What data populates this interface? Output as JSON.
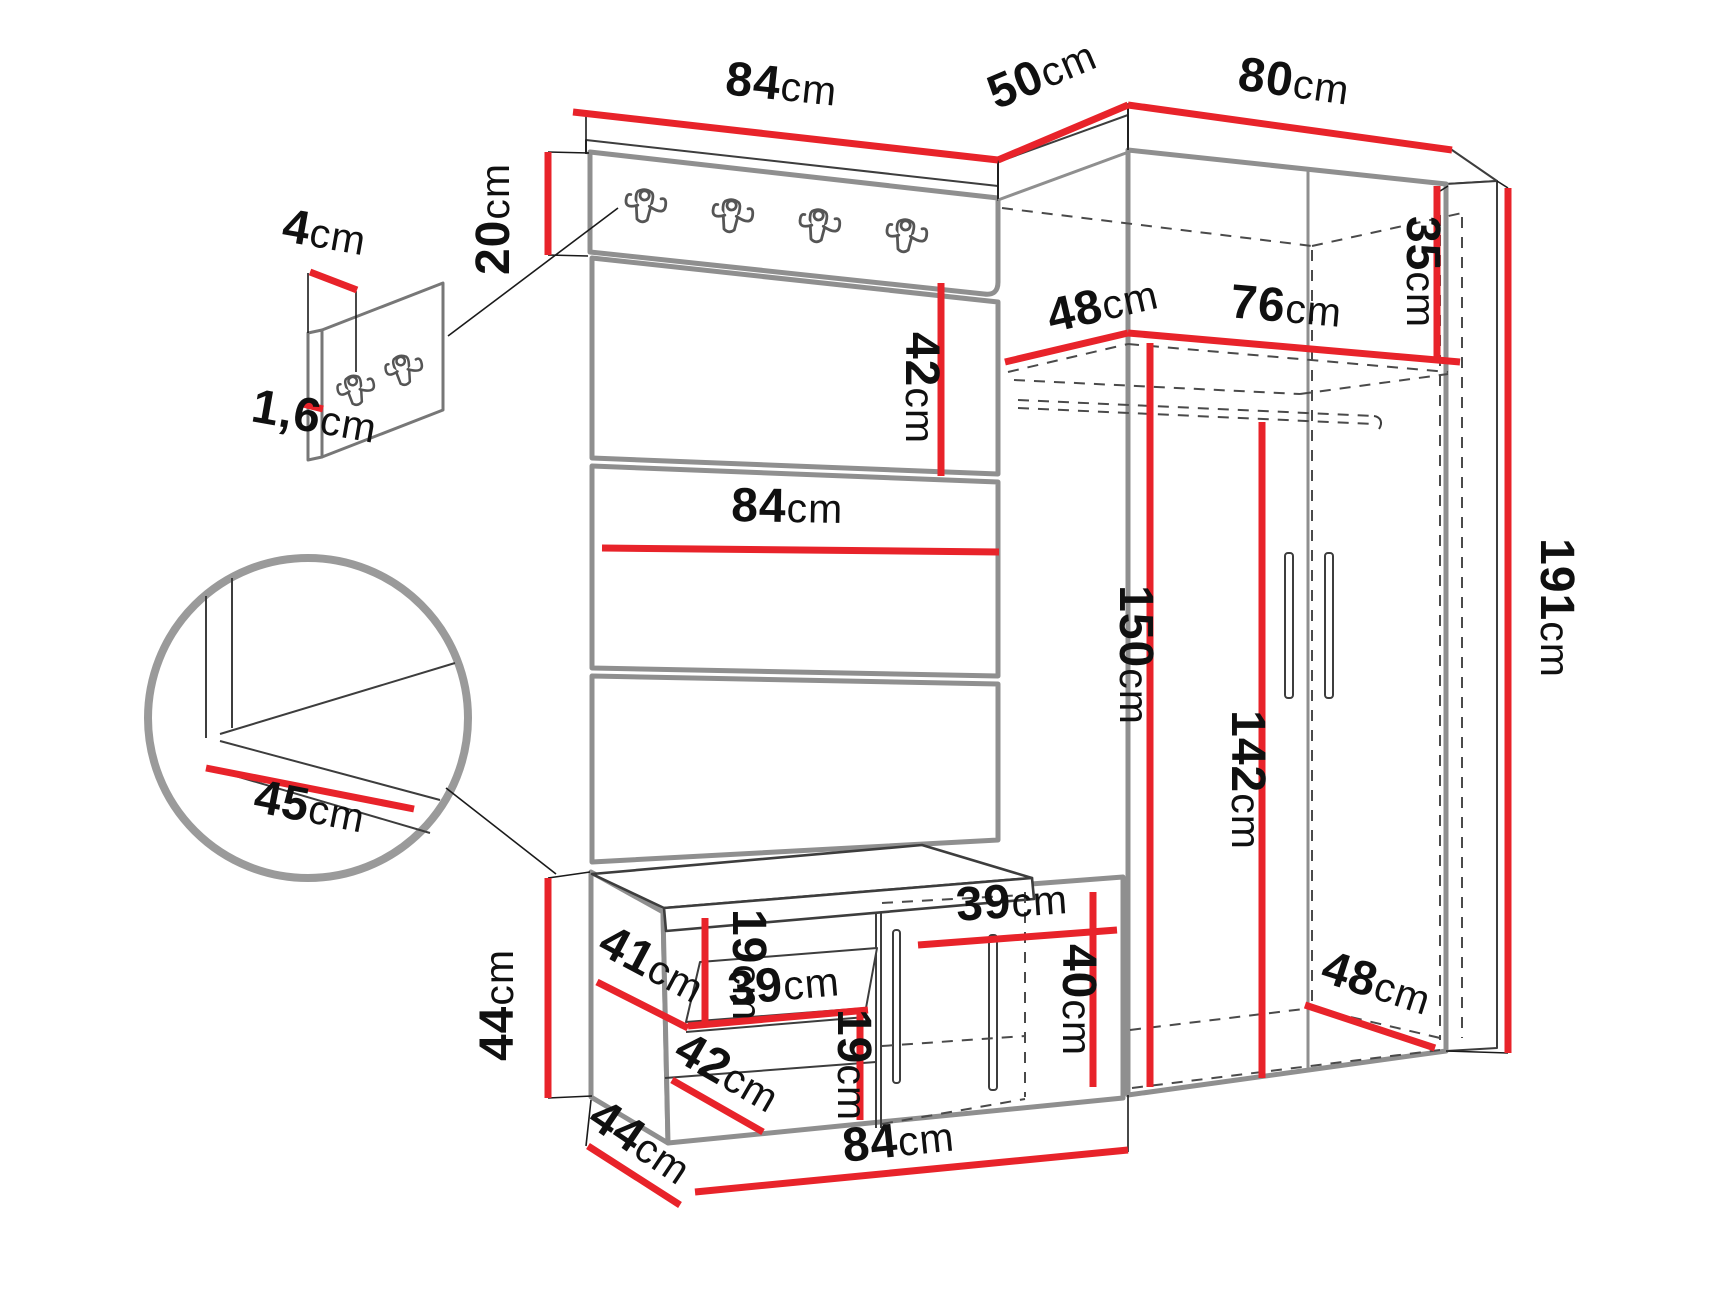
{
  "diagram": {
    "type": "furniture-dimension-diagram",
    "colors": {
      "dimension_line": "#e8232a",
      "outline": "#8f8f8f",
      "label_text": "#101010",
      "background": "#ffffff"
    },
    "icons": {
      "hook": "coat-hook-icon",
      "handle": "door-handle-icon"
    }
  },
  "dims": {
    "d84_top": {
      "value": "84",
      "unit": "cm"
    },
    "d50_top": {
      "value": "50",
      "unit": "cm"
    },
    "d80_top": {
      "value": "80",
      "unit": "cm"
    },
    "d20_left": {
      "value": "20",
      "unit": "cm"
    },
    "d4_inset": {
      "value": "4",
      "unit": "cm"
    },
    "d16_inset": {
      "value": "1,6",
      "unit": "cm"
    },
    "d42_panel": {
      "value": "42",
      "unit": "cm"
    },
    "d84_panel": {
      "value": "84",
      "unit": "cm"
    },
    "d48_shelf": {
      "value": "48",
      "unit": "cm"
    },
    "d76_shelf": {
      "value": "76",
      "unit": "cm"
    },
    "d35_shelf": {
      "value": "35",
      "unit": "cm"
    },
    "d150_wardrobe": {
      "value": "150",
      "unit": "cm"
    },
    "d142_wardrobe": {
      "value": "142",
      "unit": "cm"
    },
    "d191_height": {
      "value": "191",
      "unit": "cm"
    },
    "d45_detail": {
      "value": "45",
      "unit": "cm"
    },
    "d44_bench_height": {
      "value": "44",
      "unit": "cm"
    },
    "d41_bench": {
      "value": "41",
      "unit": "cm"
    },
    "d19_bench_upper": {
      "value": "19",
      "unit": "cm"
    },
    "d39_bench_shelf": {
      "value": "39",
      "unit": "cm"
    },
    "d42_bench_bottom": {
      "value": "42",
      "unit": "cm"
    },
    "d19_bench_lower": {
      "value": "19",
      "unit": "cm"
    },
    "d39_bench_right": {
      "value": "39",
      "unit": "cm"
    },
    "d40_bench_right": {
      "value": "40",
      "unit": "cm"
    },
    "d48_wardrobe_bottom": {
      "value": "48",
      "unit": "cm"
    },
    "d44_bench_depth": {
      "value": "44",
      "unit": "cm"
    },
    "d84_bench_width": {
      "value": "84",
      "unit": "cm"
    }
  }
}
